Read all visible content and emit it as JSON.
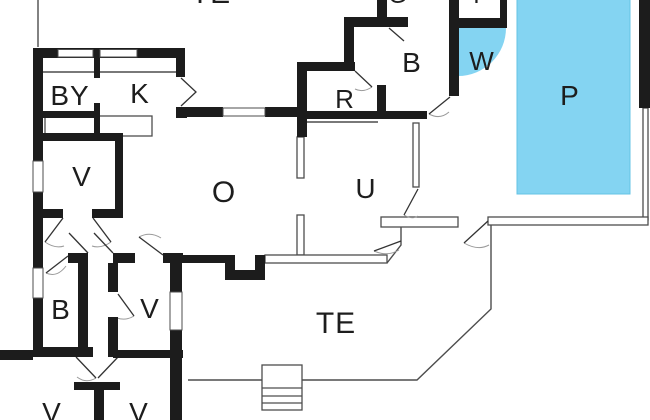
{
  "colors": {
    "wall": "#1c1c1c",
    "line": "#4d4d4d",
    "water": "#84d4f2",
    "ink": "#1d1d1d",
    "bg": "#ffffff",
    "door": "#333333",
    "arc": "#9a9a9a"
  },
  "rooms": [
    {
      "id": "te-top",
      "label": "TE",
      "x": 211,
      "y": -6,
      "size": 30
    },
    {
      "id": "by",
      "label": "BY",
      "x": 70,
      "y": 96,
      "size": 28
    },
    {
      "id": "k",
      "label": "K",
      "x": 140,
      "y": 94,
      "size": 28
    },
    {
      "id": "v-upper",
      "label": "V",
      "x": 82,
      "y": 177,
      "size": 28
    },
    {
      "id": "o",
      "label": "O",
      "x": 224,
      "y": 193,
      "size": 30
    },
    {
      "id": "r",
      "label": "R",
      "x": 345,
      "y": 99,
      "size": 26
    },
    {
      "id": "u",
      "label": "U",
      "x": 366,
      "y": 189,
      "size": 28
    },
    {
      "id": "g",
      "label": "G",
      "x": 398,
      "y": -4,
      "size": 24
    },
    {
      "id": "t",
      "label": "T",
      "x": 477,
      "y": -4,
      "size": 24
    },
    {
      "id": "b-upper",
      "label": "B",
      "x": 412,
      "y": 63,
      "size": 28
    },
    {
      "id": "w",
      "label": "W",
      "x": 482,
      "y": 61,
      "size": 26
    },
    {
      "id": "p",
      "label": "P",
      "x": 570,
      "y": 96,
      "size": 28
    },
    {
      "id": "b-lower",
      "label": "B",
      "x": 61,
      "y": 310,
      "size": 28
    },
    {
      "id": "v-mid",
      "label": "V",
      "x": 150,
      "y": 309,
      "size": 28
    },
    {
      "id": "te-bottom",
      "label": "TE",
      "x": 336,
      "y": 324,
      "size": 30
    },
    {
      "id": "v-bottom-left",
      "label": "V",
      "x": 52,
      "y": 413,
      "size": 28
    },
    {
      "id": "v-bottom-mid",
      "label": "V",
      "x": 139,
      "y": 413,
      "size": 28
    }
  ]
}
